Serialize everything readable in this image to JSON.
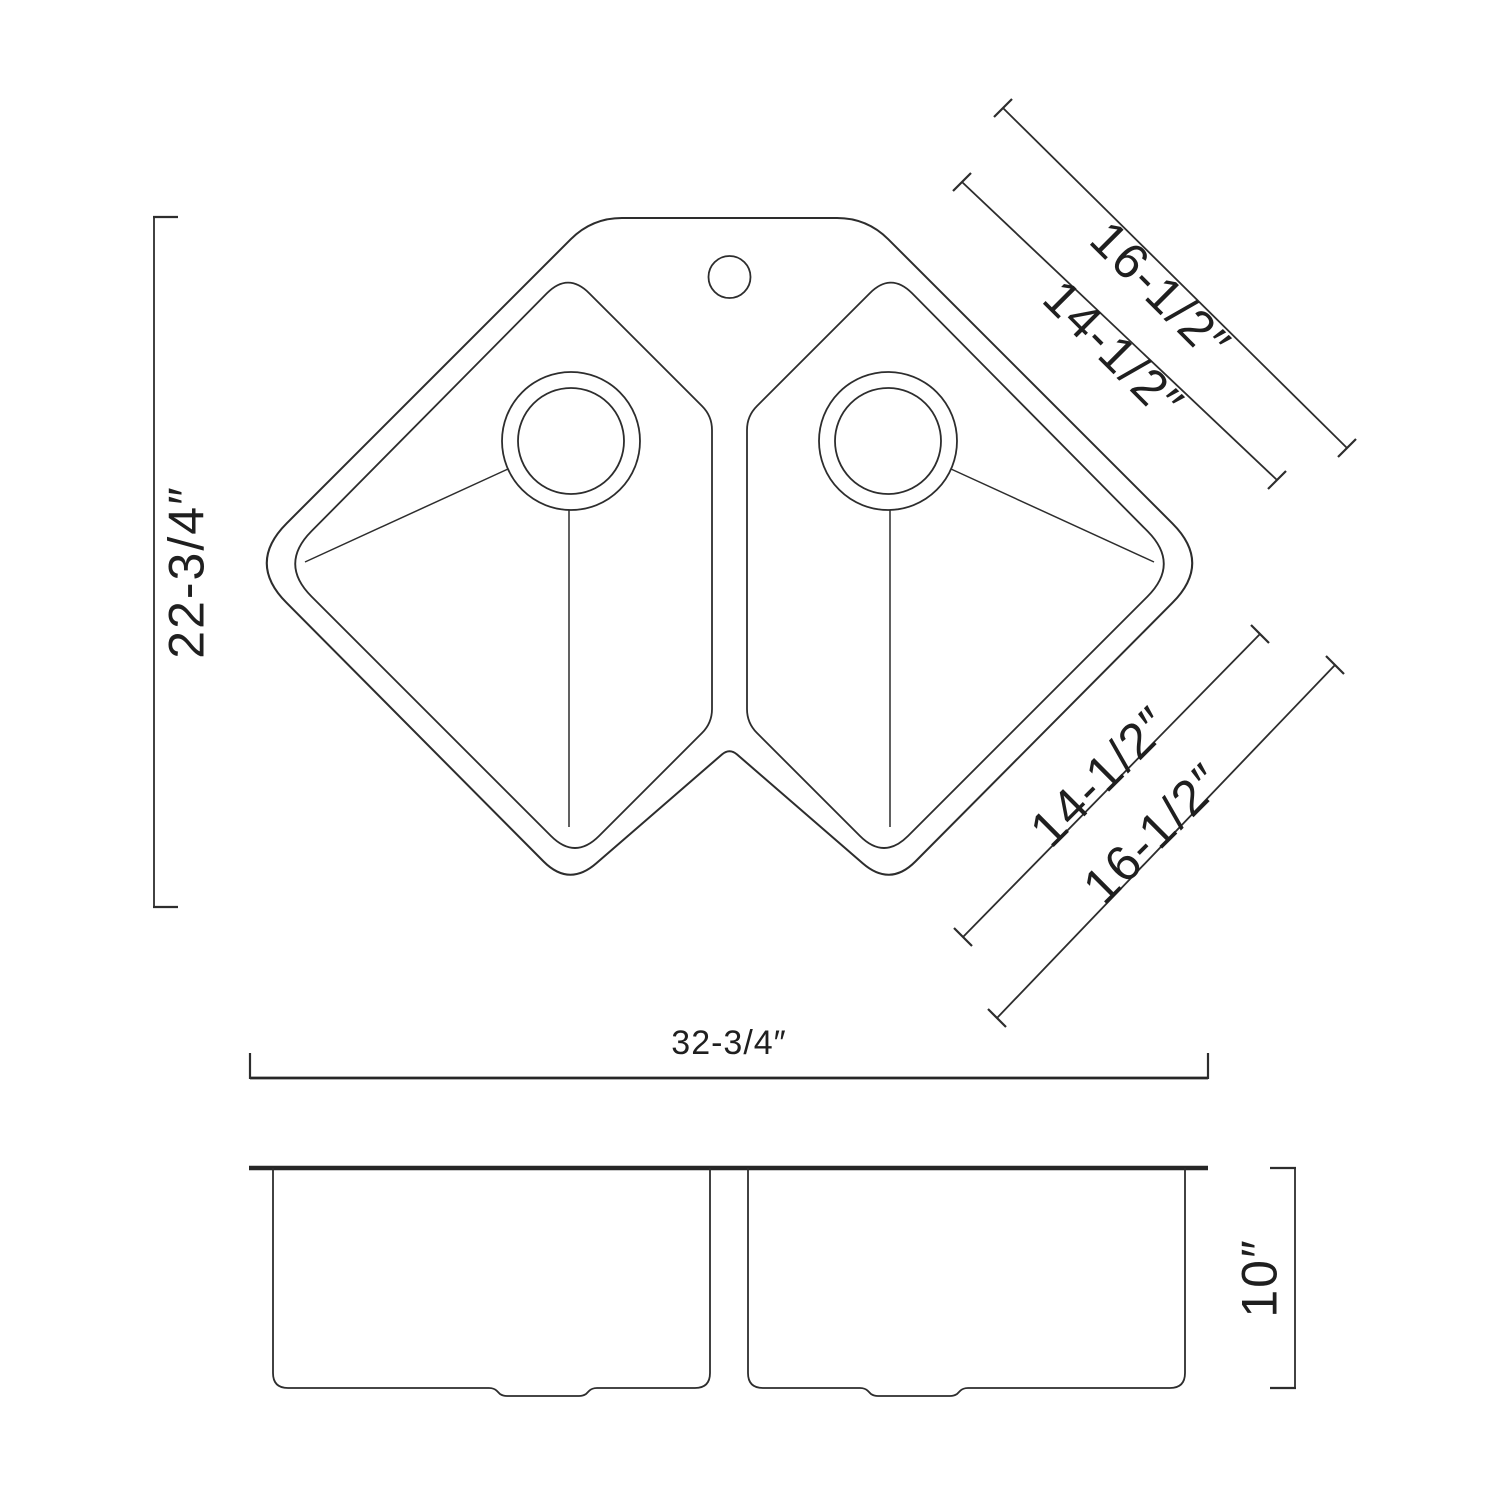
{
  "page": {
    "background_color": "#ffffff",
    "line_color": "#2d2d2d"
  },
  "drawing": {
    "type": "technical dimension drawing",
    "subject": "corner double-bowl kitchen sink",
    "units": "inches",
    "views": {
      "top": {
        "overall_height_label": "22-3/4″",
        "overall_width_label": "32-3/4″",
        "top_right_outer_label": "16-1/2″",
        "top_right_inner_label": "14-1/2″",
        "bottom_right_inner_label": "14-1/2″",
        "bottom_right_outer_label": "16-1/2″"
      },
      "side": {
        "depth_label": "10″"
      }
    },
    "features": {
      "faucet_hole": "single faucet hole, top center",
      "drains": "one round drain per bowl",
      "bowls": 2
    }
  }
}
